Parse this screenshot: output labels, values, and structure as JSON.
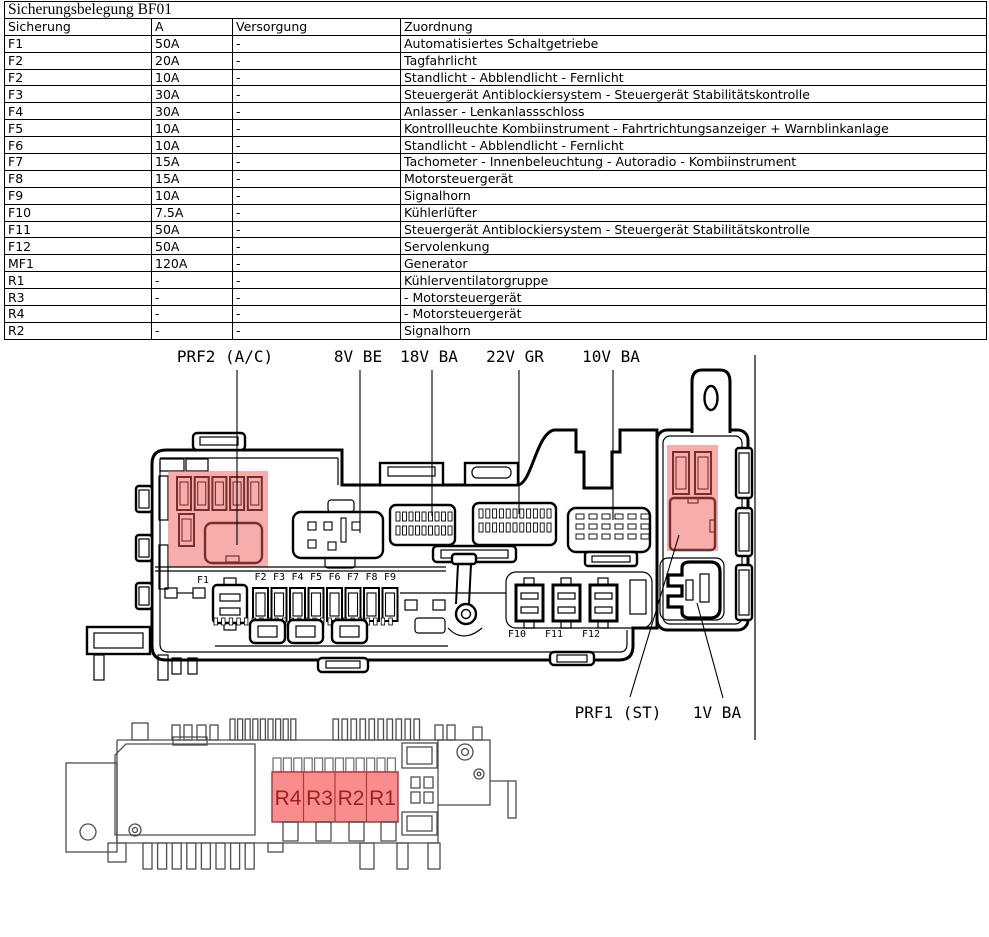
{
  "table": {
    "title": "Sicherungsbelegung BF01",
    "columns": [
      "Sicherung",
      "A",
      "Versorgung",
      "Zuordnung"
    ],
    "rows": [
      [
        "F1",
        "50A",
        "-",
        "Automatisiertes Schaltgetriebe"
      ],
      [
        "F2",
        "20A",
        "-",
        "Tagfahrlicht"
      ],
      [
        "F2",
        "10A",
        "-",
        "Standlicht - Abblendlicht - Fernlicht"
      ],
      [
        "F3",
        "30A",
        "-",
        "Steuergerät Antiblockiersystem - Steuergerät Stabilitätskontrolle"
      ],
      [
        "F4",
        "30A",
        "-",
        "Anlasser - Lenkanlassschloss"
      ],
      [
        "F5",
        "10A",
        "-",
        "Kontrollleuchte Kombiinstrument - Fahrtrichtungsanzeiger + Warnblinkanlage"
      ],
      [
        "F6",
        "10A",
        "-",
        "Standlicht - Abblendlicht - Fernlicht"
      ],
      [
        "F7",
        "15A",
        "-",
        "Tachometer - Innenbeleuchtung - Autoradio - Kombiinstrument"
      ],
      [
        "F8",
        "15A",
        "-",
        "Motorsteuergerät"
      ],
      [
        "F9",
        "10A",
        "-",
        "Signalhorn"
      ],
      [
        "F10",
        "7.5A",
        "-",
        "Kühlerlüfter"
      ],
      [
        "F11",
        "50A",
        "-",
        "Steuergerät Antiblockiersystem - Steuergerät Stabilitätskontrolle"
      ],
      [
        "F12",
        "50A",
        "-",
        "Servolenkung"
      ],
      [
        "MF1",
        "120A",
        "-",
        "Generator"
      ],
      [
        "R1",
        "-",
        "-",
        "Kühlerventilatorgruppe"
      ],
      [
        "R3",
        "-",
        "-",
        "- Motorsteuergerät"
      ],
      [
        "R4",
        "-",
        "-",
        "- Motorsteuergerät"
      ],
      [
        "R2",
        "-",
        "-",
        "Signalhorn"
      ]
    ]
  },
  "diagram": {
    "top_labels": [
      "PRF2 (A/C)",
      "8V BE",
      "18V BA",
      "22V GR",
      "10V BA"
    ],
    "bottom_labels": [
      "PRF1 (ST)",
      "1V BA"
    ],
    "fuse_label_f1": "F1",
    "fuse_row": [
      "F2",
      "F3",
      "F4",
      "F5",
      "F6",
      "F7",
      "F8",
      "F9"
    ],
    "maxi_fuse_row": [
      "F10",
      "F11",
      "F12"
    ],
    "relay_cells": [
      "R4",
      "R3",
      "R2",
      "R1"
    ],
    "colors": {
      "highlight": "#f25c5c",
      "relay_fill": "#f98c8c",
      "relay_border": "#b03a3a",
      "relay_text": "#9e2020"
    }
  }
}
